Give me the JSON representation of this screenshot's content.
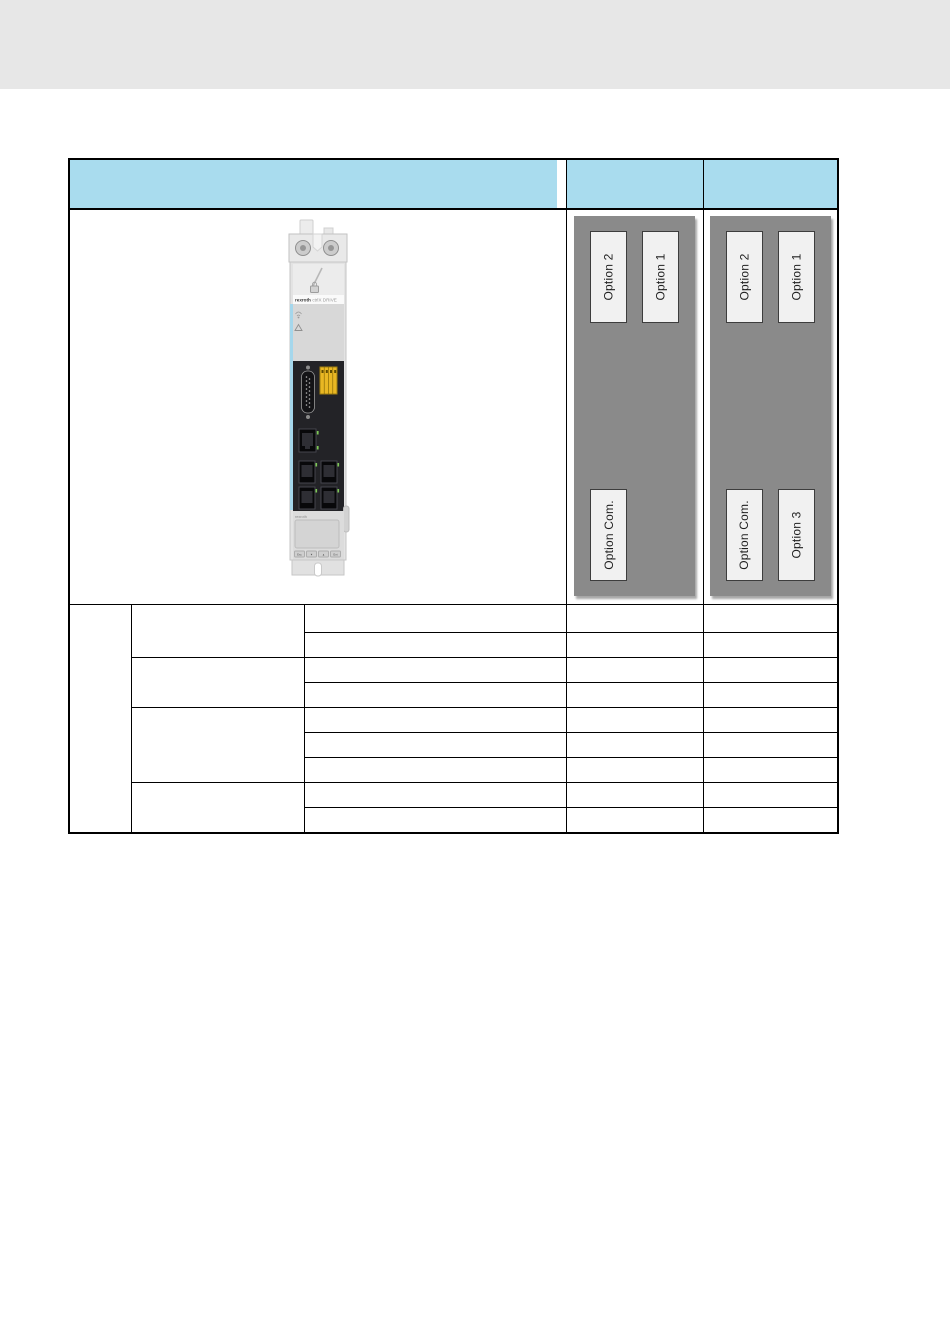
{
  "page": {
    "background_color": "#ffffff",
    "top_band_color": "#e7e7e7"
  },
  "table": {
    "header": {
      "bg_color": "#a9dcee",
      "main_label": "",
      "col2_label": "",
      "col3_label": ""
    },
    "device": {
      "brand": "rexroth",
      "product": "ctrlX DRIVE",
      "bottom_brand": "rexroth",
      "keypad": [
        "Esc",
        "▼",
        "▲",
        "Ent"
      ],
      "accent_stripe_color": "#a5d7ec",
      "terminal_block_color": "#e9b723",
      "led_color": "#7dc855"
    },
    "panels": [
      {
        "bg_color": "#8a8a8a",
        "slot_bg_color": "#f1f1f1",
        "top_slots": [
          "Option 2",
          "Option 1"
        ],
        "bottom_slots": [
          "Option Com."
        ]
      },
      {
        "bg_color": "#8a8a8a",
        "slot_bg_color": "#f1f1f1",
        "top_slots": [
          "Option 2",
          "Option 1"
        ],
        "bottom_slots": [
          "Option Com.",
          "Option 3"
        ]
      }
    ],
    "body": {
      "left_column_rowspan": 9,
      "left_column_text": "",
      "group_rowspans": [
        2,
        2,
        3,
        2
      ],
      "group_texts": [
        "",
        "",
        "",
        ""
      ],
      "rows": [
        [
          "",
          "",
          ""
        ],
        [
          "",
          "",
          ""
        ],
        [
          "",
          "",
          ""
        ],
        [
          "",
          "",
          ""
        ],
        [
          "",
          "",
          ""
        ],
        [
          "",
          "",
          ""
        ],
        [
          "",
          "",
          ""
        ],
        [
          "",
          "",
          ""
        ],
        [
          "",
          "",
          ""
        ]
      ]
    }
  }
}
